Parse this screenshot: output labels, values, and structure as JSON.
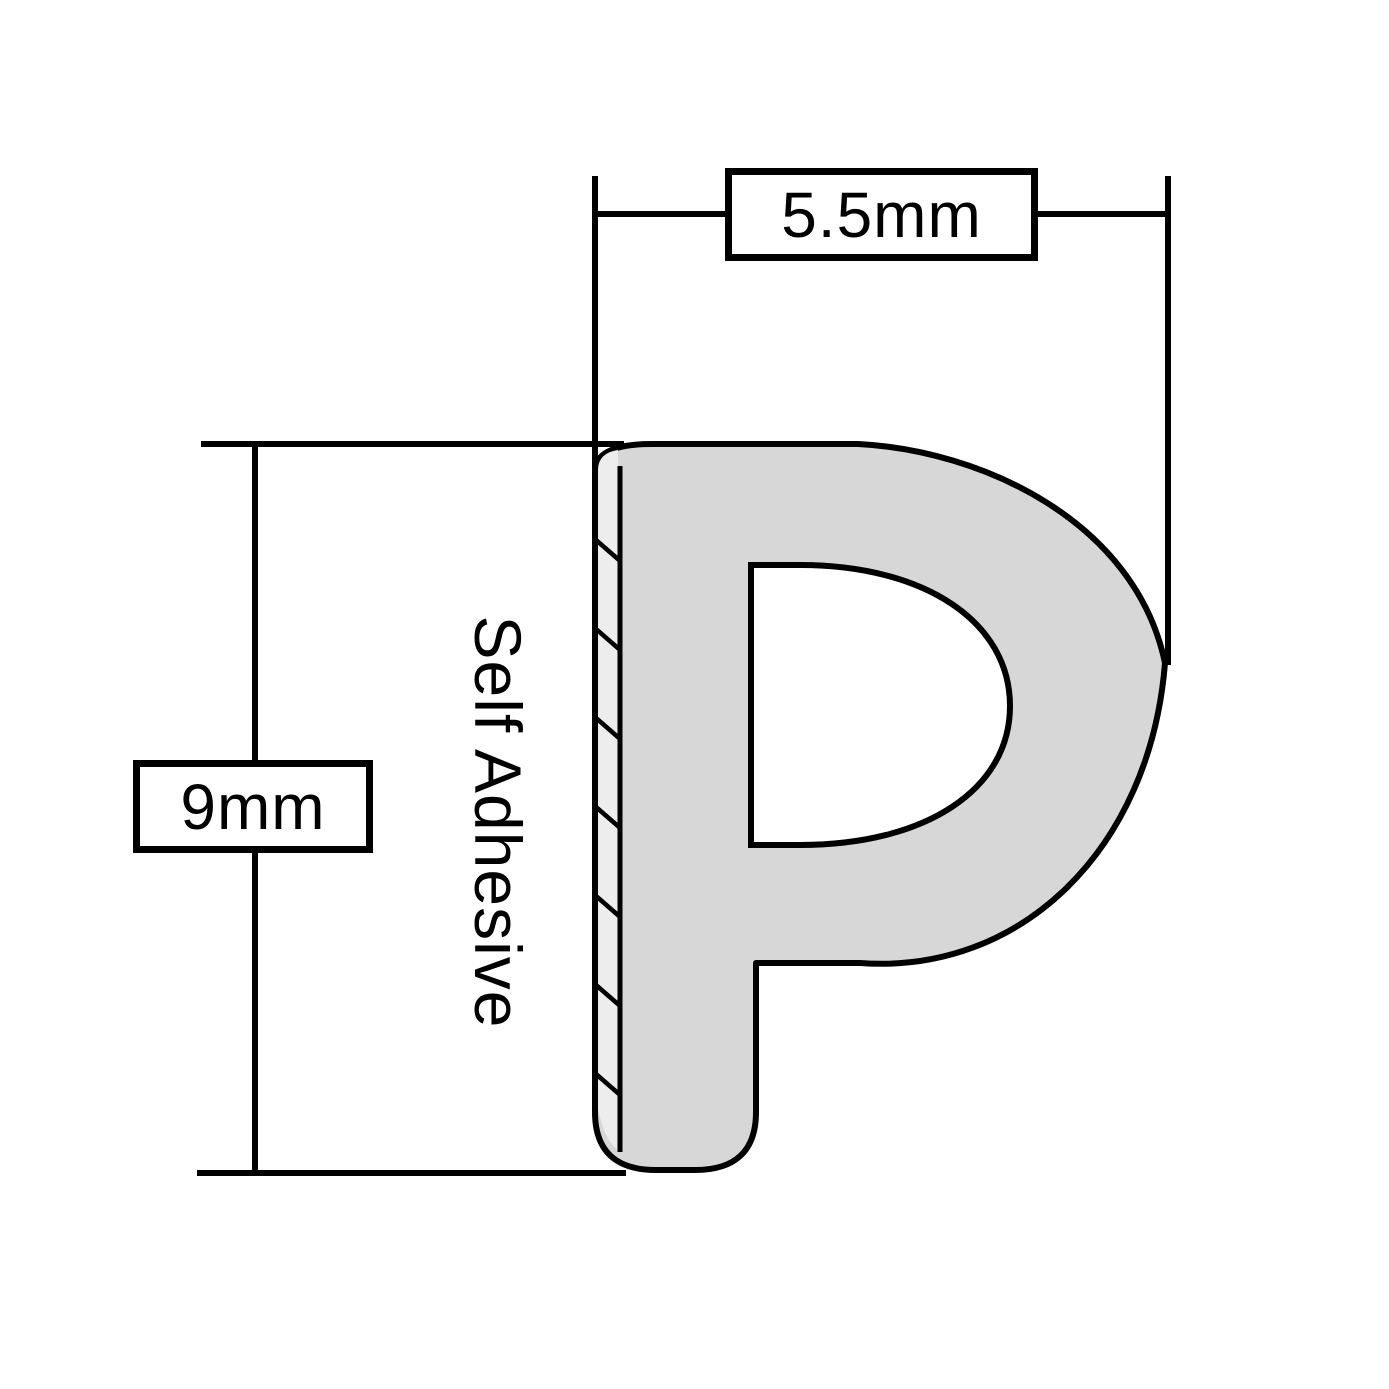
{
  "diagram": {
    "dimensions": {
      "width_label": "5.5mm",
      "height_label": "9mm"
    },
    "adhesive_label": "Self Adhesive",
    "colors": {
      "outline": "#000000",
      "profile_fill": "#d7d7d7",
      "adhesive_strip_fill": "#ededed",
      "background": "#ffffff",
      "text": "#000000"
    }
  }
}
